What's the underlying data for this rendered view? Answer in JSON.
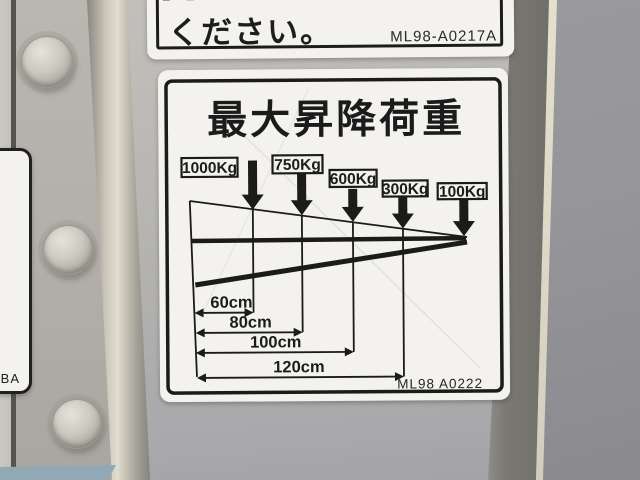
{
  "top_label": {
    "visible_text": "ください。",
    "part_number": "ML98-A0217A"
  },
  "main_label": {
    "title": "最大昇降荷重",
    "loads": [
      "1000Kg",
      "750Kg",
      "600Kg",
      "300Kg",
      "100Kg"
    ],
    "distances": [
      "60cm",
      "80cm",
      "100cm",
      "120cm"
    ],
    "part_number": "ML98 A0222",
    "capacity_by_distance": [
      {
        "distance_cm": 60,
        "max_load_kg": 1000
      },
      {
        "distance_cm": 80,
        "max_load_kg": 750
      },
      {
        "distance_cm": 100,
        "max_load_kg": 600
      },
      {
        "distance_cm": 120,
        "max_load_kg": 300
      },
      {
        "distance_cm": null,
        "max_load_kg": 100
      }
    ]
  },
  "side_label_fragment": {
    "text": "BA"
  },
  "colors": {
    "label_background": "#f3f2ee",
    "ink": "#1b1b1b",
    "door_panel": "#b7b6b2",
    "background": "#96959a",
    "edge_highlight": "#dcd7c6",
    "edge_shadow": "#6e6c66",
    "hinge_metal": "#e1dcce",
    "floor": "#93a8b5"
  }
}
